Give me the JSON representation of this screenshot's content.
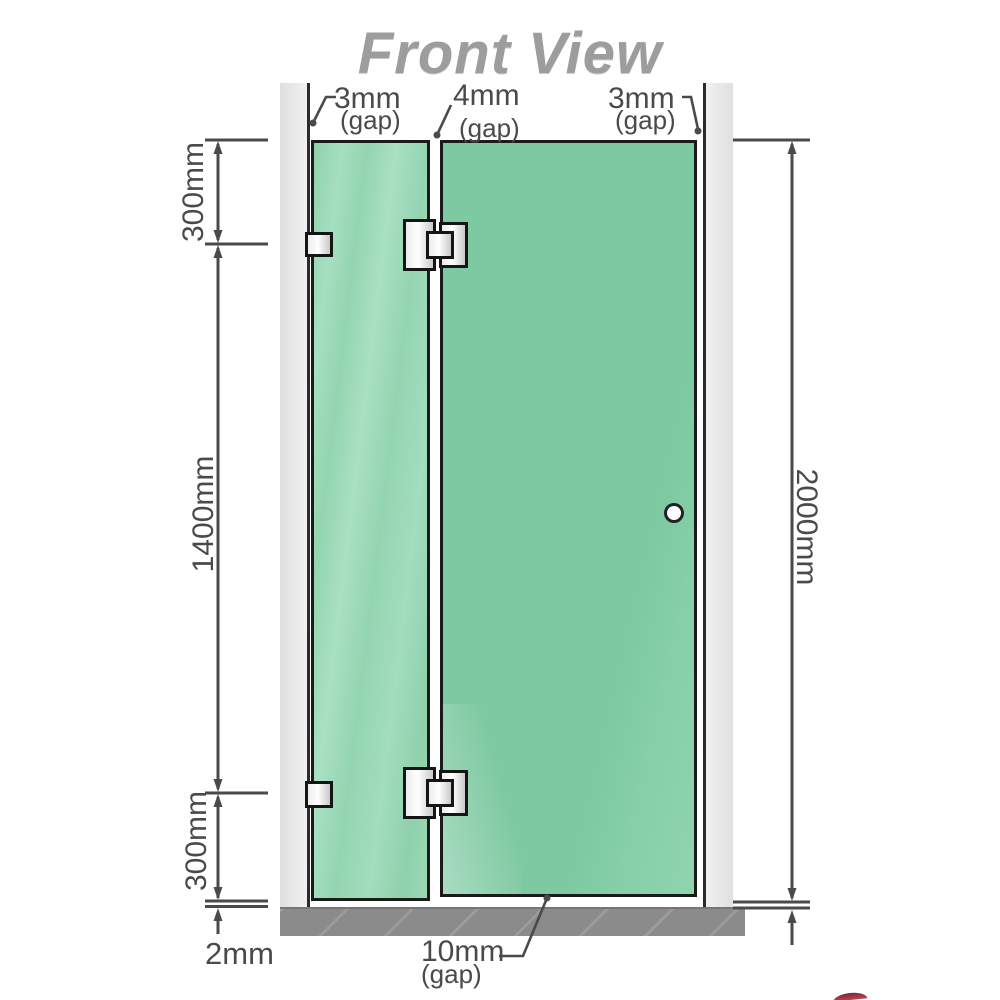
{
  "title": "Front View",
  "labels": {
    "gap_left": {
      "value": "3mm",
      "suffix": "(gap)"
    },
    "gap_middle": {
      "value": "4mm",
      "suffix": "(gap)"
    },
    "gap_right": {
      "value": "3mm",
      "suffix": "(gap)"
    },
    "gap_bottom": {
      "value": "10mm",
      "suffix": "(gap)"
    },
    "dim_top_left": "300mm",
    "dim_middle_left": "1400mm",
    "dim_bottom_left": "300mm",
    "dim_floor_gap": "2mm",
    "dim_overall_right": "2000mm"
  },
  "colors": {
    "title": "#9d9d9d",
    "dimension": "#4a4a4a",
    "outline": "#1b1b1b",
    "glass_fixed": "#9ad8b5",
    "glass_door": "#7dc9a1",
    "wall": "#e9e9e9",
    "floor": "#8b8b8b",
    "hardware": "#e8e8e8"
  }
}
